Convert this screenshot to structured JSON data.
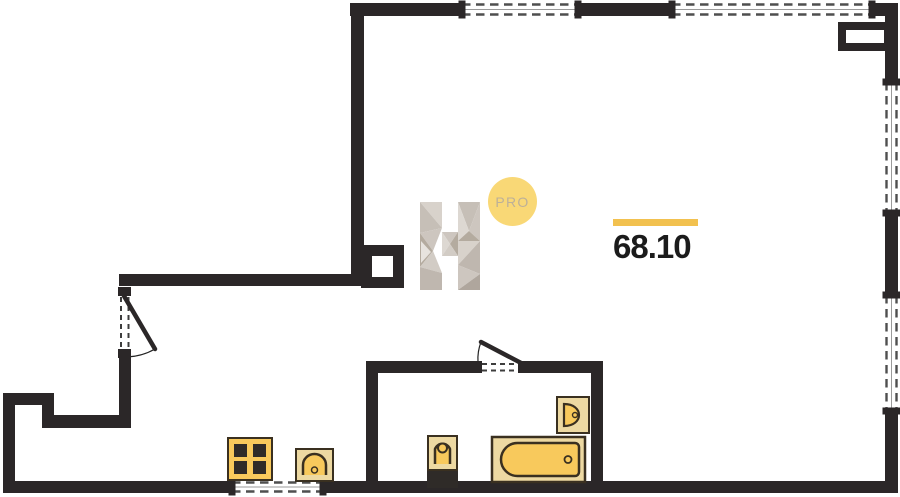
{
  "palette": {
    "wall": "#2b2728",
    "window_dash": "#4f4f4f",
    "window_sill": "#9a9a9a",
    "door_dash": "#3d3d3d",
    "fixture_fill": "#f8c95c",
    "fixture_pale": "#edd9a2",
    "fixture_stroke": "#3a3020",
    "fixture_dark": "#2f2b28"
  },
  "area_label": {
    "value": "68.10",
    "bar_color": "#f2c14f",
    "text_color": "#1b1b1b"
  },
  "logo": {
    "letter": "H",
    "badge": "PRO",
    "circle_color": "#f9d876",
    "badge_text_color": "#bdb098",
    "facet_colors": [
      "#d8d2cb",
      "#c6bfb7",
      "#cdc6bf",
      "#b4ab9f",
      "#e7e3de",
      "#d2ccc5",
      "#bfb7af",
      "#ddd8d2",
      "#afa69d"
    ],
    "facets": [
      {
        "c": 0,
        "p": "420,202 442,202 442,228"
      },
      {
        "c": 1,
        "p": "420,202 442,228 420,233"
      },
      {
        "c": 2,
        "p": "420,233 442,228 433,251"
      },
      {
        "c": 3,
        "p": "420,233 433,251 420,267"
      },
      {
        "c": 4,
        "p": "421,241 431,252 421,263"
      },
      {
        "c": 5,
        "p": "420,267 433,251 442,273"
      },
      {
        "c": 6,
        "p": "420,267 442,273 442,290 420,290"
      },
      {
        "c": 2,
        "p": "442,232 458,232 450,244"
      },
      {
        "c": 7,
        "p": "442,232 450,244 442,256"
      },
      {
        "c": 3,
        "p": "458,232 458,256 450,244"
      },
      {
        "c": 5,
        "p": "442,256 450,244 458,256"
      },
      {
        "c": 1,
        "p": "458,202 480,202 469,231"
      },
      {
        "c": 7,
        "p": "458,202 469,231 458,241"
      },
      {
        "c": 2,
        "p": "480,202 480,241 469,231"
      },
      {
        "c": 3,
        "p": "458,241 469,231 480,241"
      },
      {
        "c": 0,
        "p": "458,241 480,241 458,265"
      },
      {
        "c": 6,
        "p": "480,241 458,265 480,274"
      },
      {
        "c": 2,
        "p": "458,265 480,274 458,290"
      },
      {
        "c": 8,
        "p": "480,274 458,290 480,290"
      }
    ]
  },
  "plan": {
    "walls": [
      {
        "name": "top-wall",
        "x": 350,
        "y": 3,
        "w": 548,
        "h": 13
      },
      {
        "name": "right-wall",
        "x": 885,
        "y": 3,
        "w": 13,
        "h": 490
      },
      {
        "name": "upper-left-wall",
        "x": 351,
        "y": 3,
        "w": 13,
        "h": 283
      },
      {
        "name": "entry-wall",
        "x": 119,
        "y": 274,
        "w": 246,
        "h": 12
      },
      {
        "name": "left-wall-middle",
        "x": 119,
        "y": 356,
        "w": 12,
        "h": 62
      },
      {
        "name": "step-wall-top",
        "x": 42,
        "y": 415,
        "w": 89,
        "h": 13
      },
      {
        "name": "step-wall-side",
        "x": 42,
        "y": 393,
        "w": 12,
        "h": 35
      },
      {
        "name": "pocket-wall-top",
        "x": 3,
        "y": 393,
        "w": 51,
        "h": 12
      },
      {
        "name": "left-wall-lower",
        "x": 3,
        "y": 393,
        "w": 12,
        "h": 100
      },
      {
        "name": "bottom-wall",
        "x": 3,
        "y": 481,
        "w": 895,
        "h": 12
      },
      {
        "name": "bathroom-west-wall",
        "x": 366,
        "y": 361,
        "w": 12,
        "h": 120
      },
      {
        "name": "bathroom-north-wall-left",
        "x": 366,
        "y": 361,
        "w": 109,
        "h": 12
      },
      {
        "name": "bathroom-north-wall-right",
        "x": 525,
        "y": 361,
        "w": 78,
        "h": 12
      },
      {
        "name": "bathroom-east-wall",
        "x": 591,
        "y": 361,
        "w": 12,
        "h": 120
      }
    ],
    "windows": [
      {
        "name": "window-top-1",
        "x": 462,
        "y": 3,
        "w": 116,
        "h": 13,
        "dir": "h"
      },
      {
        "name": "window-top-2",
        "x": 672,
        "y": 3,
        "w": 200,
        "h": 13,
        "dir": "h"
      },
      {
        "name": "window-right-1",
        "x": 885,
        "y": 82,
        "w": 13,
        "h": 131,
        "dir": "v"
      },
      {
        "name": "window-right-2",
        "x": 885,
        "y": 295,
        "w": 13,
        "h": 116,
        "dir": "v"
      },
      {
        "name": "window-bottom",
        "x": 232,
        "y": 481,
        "w": 91,
        "h": 12,
        "dir": "h"
      }
    ],
    "shafts": [
      {
        "name": "shaft-column-left",
        "x": 361,
        "y": 245,
        "w": 43,
        "h": 43,
        "t": 11
      },
      {
        "name": "shaft-top-right",
        "x": 838,
        "y": 22,
        "w": 54,
        "h": 29,
        "t": 8
      }
    ],
    "doors": [
      {
        "name": "entrance-door",
        "stubs": [
          [
            118,
            287,
            13,
            9
          ],
          [
            118,
            349,
            13,
            9
          ]
        ],
        "dashes": [
          [
            121,
            297,
            121,
            348
          ],
          [
            128.5,
            297,
            128.5,
            348
          ]
        ],
        "leaf": [
          124,
          296,
          155,
          349
        ],
        "arc": "M155,349 A61 61 0 0 1 126,357"
      },
      {
        "name": "bathroom-door",
        "stubs": [
          [
            473,
            361,
            9,
            12
          ],
          [
            518,
            361,
            9,
            12
          ]
        ],
        "dashes": [
          [
            482,
            364,
            518,
            364
          ],
          [
            482,
            370.5,
            518,
            370.5
          ]
        ],
        "leaf": [
          523,
          364,
          481,
          342
        ],
        "arc": "M481,342 A47 47 0 0 0 478,362"
      }
    ],
    "fixtures": [
      {
        "name": "stove",
        "type": "stove",
        "x": 228,
        "y": 438,
        "w": 44,
        "h": 42
      },
      {
        "name": "kitchen-sink",
        "type": "sink-arch",
        "x": 296,
        "y": 449,
        "w": 37,
        "h": 32
      },
      {
        "name": "toilet",
        "type": "toilet",
        "x": 428,
        "y": 436,
        "w": 29,
        "h": 52
      },
      {
        "name": "bathtub",
        "type": "bathtub",
        "x": 492,
        "y": 437,
        "w": 93,
        "h": 45
      },
      {
        "name": "bathroom-sink",
        "type": "sink-d",
        "x": 557,
        "y": 397,
        "w": 32,
        "h": 36
      }
    ]
  }
}
